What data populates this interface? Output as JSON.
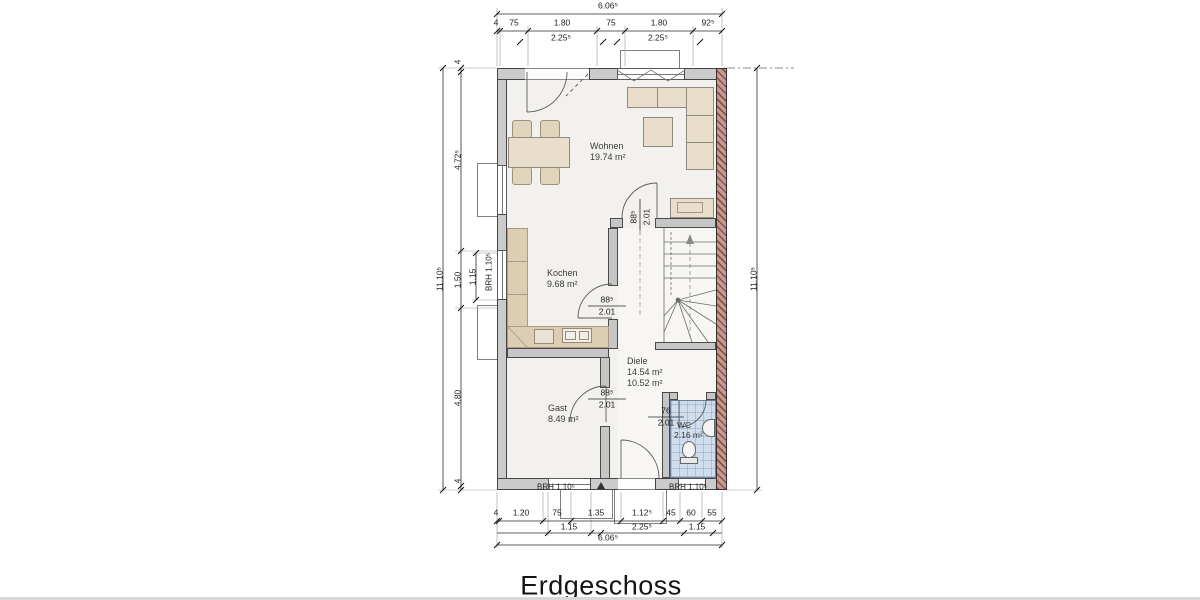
{
  "title": "Erdgeschoss",
  "rooms": {
    "wohnen": {
      "name": "Wohnen",
      "area": "19.74 m²"
    },
    "kochen": {
      "name": "Kochen",
      "area": "9.68 m²"
    },
    "diele": {
      "name": "Diele",
      "area1": "14.54 m²",
      "area2": "10.52 m²"
    },
    "gast": {
      "name": "Gast",
      "area": "8.49 m²"
    },
    "wc": {
      "name": "WC",
      "area": "2.16 m²"
    }
  },
  "dims": {
    "top": {
      "overall": "6.06⁵",
      "row": [
        "4",
        "75",
        "1.80",
        "75",
        "1.80",
        "92⁵"
      ],
      "sub": [
        "2.25⁵",
        "2.25⁵"
      ]
    },
    "bottom": {
      "overall": "6.06⁵",
      "row": [
        "4",
        "1.20",
        "75",
        "1.35",
        "1.12⁵",
        "45",
        "60",
        "55"
      ],
      "sub": [
        "1.15",
        "2.25⁵",
        "1.15"
      ]
    },
    "left": {
      "overall": "11.10⁵",
      "row": [
        "4",
        "4.72⁵",
        "1.50",
        "4.80",
        "4"
      ],
      "sub": "1.15"
    },
    "right": {
      "overall": "11.10⁵"
    }
  },
  "openings": {
    "door_wohnen_diele": {
      "w": "88⁵",
      "h": "2.01"
    },
    "door_kochen": {
      "w": "88⁵",
      "h": "2.01"
    },
    "door_gast": {
      "w": "88⁵",
      "h": "2.01"
    },
    "door_wc": {
      "w": "76",
      "h": "2.01"
    },
    "window_left_brh": "BRH 1.10⁵",
    "window_gast_brh": "BRH 1.10⁵",
    "window_wc_brh": "BRH 1.10⁵"
  },
  "colors": {
    "wall": "#cbcbcb",
    "party_wall": "#c29b94",
    "party_wall_hatch": "#8c5047",
    "wc_floor": "#cfdded",
    "furniture": "#e9decb",
    "line": "#3c3c3c"
  }
}
